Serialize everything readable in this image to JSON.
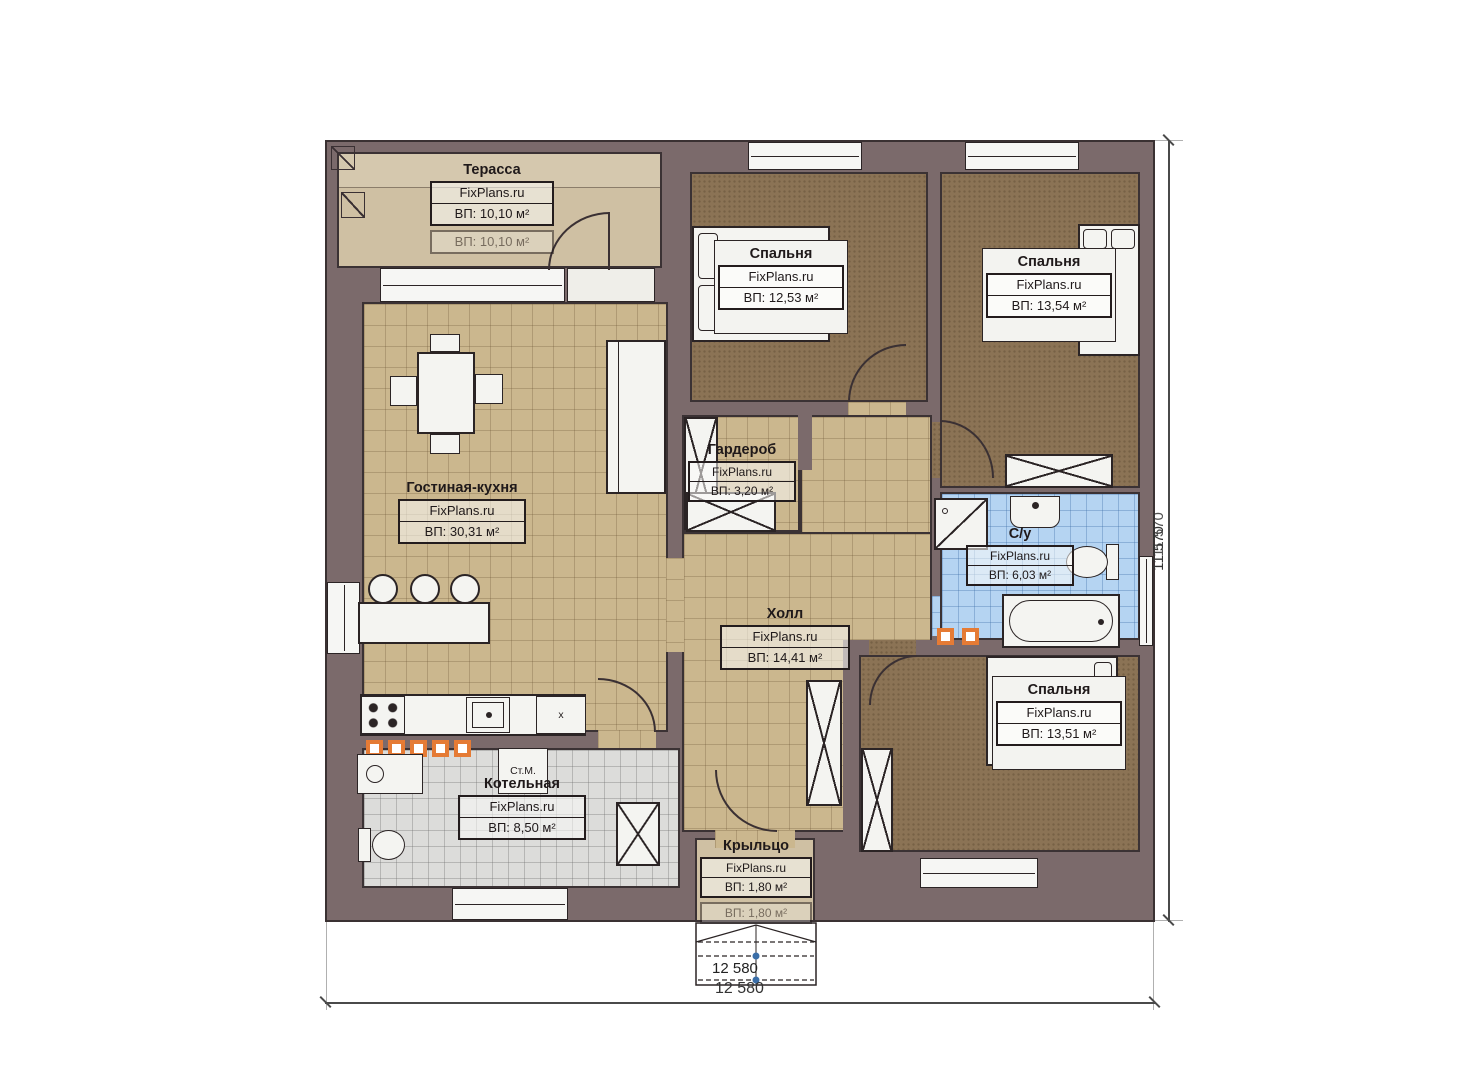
{
  "plan": {
    "watermark": "FixPlans.ru",
    "rooms": {
      "terrace": {
        "name": "Терасса",
        "area": "ВП: 10,10 м²",
        "area_faded": "ВП: 10,10 м²"
      },
      "bedroom1": {
        "name": "Спальня",
        "area": "ВП: 12,53 м²"
      },
      "bedroom2": {
        "name": "Спальня",
        "area": "ВП: 13,54 м²"
      },
      "living": {
        "name": "Гостиная-кухня",
        "area": "ВП: 30,31 м²"
      },
      "wardrobe": {
        "name": "Гардероб",
        "area": "ВП: 3,20 м²"
      },
      "hall": {
        "name": "Холл",
        "area": "ВП: 14,41 м²"
      },
      "bathroom": {
        "name": "С/у",
        "area": "ВП: 6,03 м²"
      },
      "bedroom3": {
        "name": "Спальня",
        "area": "ВП: 13,51 м²"
      },
      "boiler": {
        "name": "Котельная",
        "area": "ВП: 8,50 м²"
      },
      "porch": {
        "name": "Крыльцо",
        "area": "ВП: 1,80 м²",
        "area_faded": "ВП: 1,80 м²"
      }
    },
    "appliances": {
      "washing_machine": "Ст.М.",
      "cabinet_mark": "x"
    },
    "dimensions": {
      "bottom": "12 580",
      "steps": "12 580",
      "right": "11 570",
      "right_overlap": "11 570"
    },
    "colors": {
      "wall": "#7b6a6b",
      "floor_tile_tan": "#cbb78e",
      "floor_carpet": "#8b7355",
      "floor_bath_tile": "#b5d4f2",
      "floor_boiler_tile": "#dcdcda",
      "floor_terrace": "#cfc0a3",
      "accent_orange": "#e57b35"
    }
  }
}
